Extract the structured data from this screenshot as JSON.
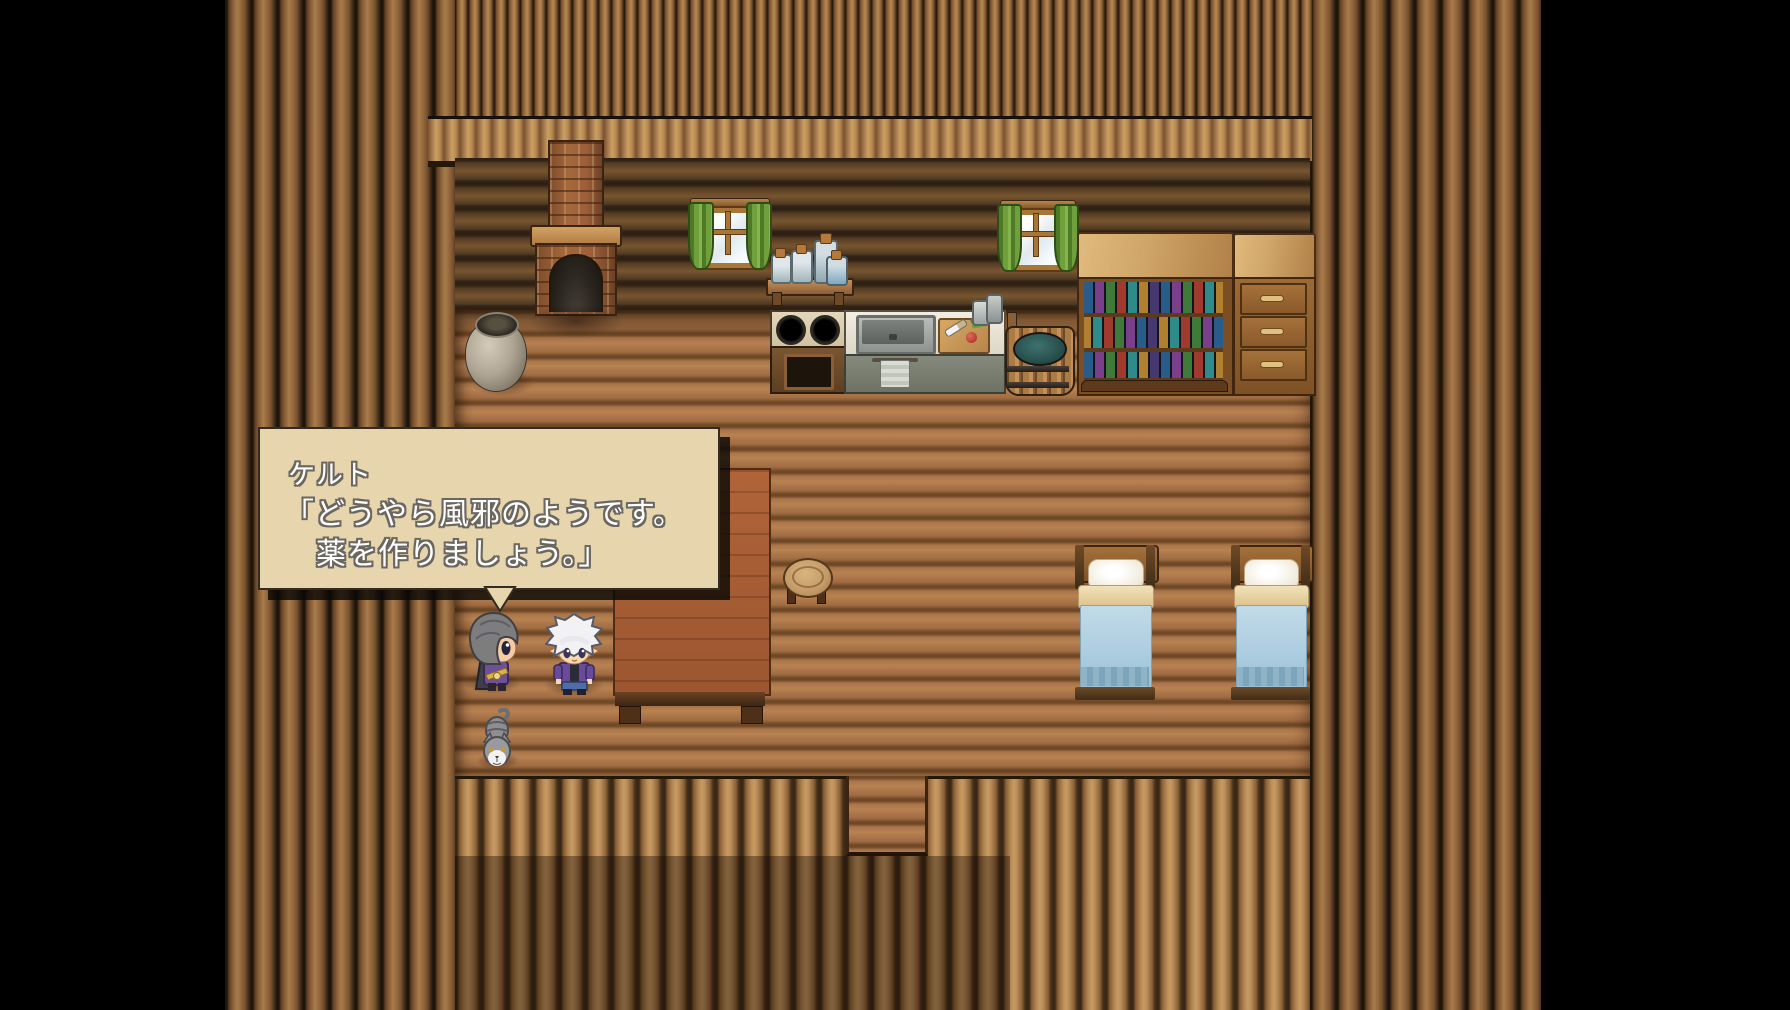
{
  "dialog": {
    "speaker": "ケルト",
    "line1": "「どうやら風邪のようです。",
    "line2": "薬を作りましょう。」"
  },
  "scene": {
    "objects": [
      "fireplace",
      "window-left",
      "window-right",
      "jar-shelf",
      "stove",
      "sink-counter",
      "cutting-board",
      "water-bucket",
      "bookshelf",
      "dresser",
      "bed-left",
      "bed-right",
      "table",
      "stool",
      "clay-pot",
      "elf-gray",
      "elf-white",
      "cat"
    ],
    "colors": {
      "letterbox": "#000000",
      "dialog_bg": "#e7d5ae",
      "dialog_border": "#332a20",
      "dialog_text": "#ffffff",
      "dialog_text_outline": "#6b675f",
      "floor": "#b07a4e",
      "interior_wall": "#6b4c2c",
      "exterior_logs": "#9a6e40",
      "curtain_green": "#6fa03c",
      "blanket_blue": "#aecde0",
      "brick": "#9c5f3a"
    }
  }
}
